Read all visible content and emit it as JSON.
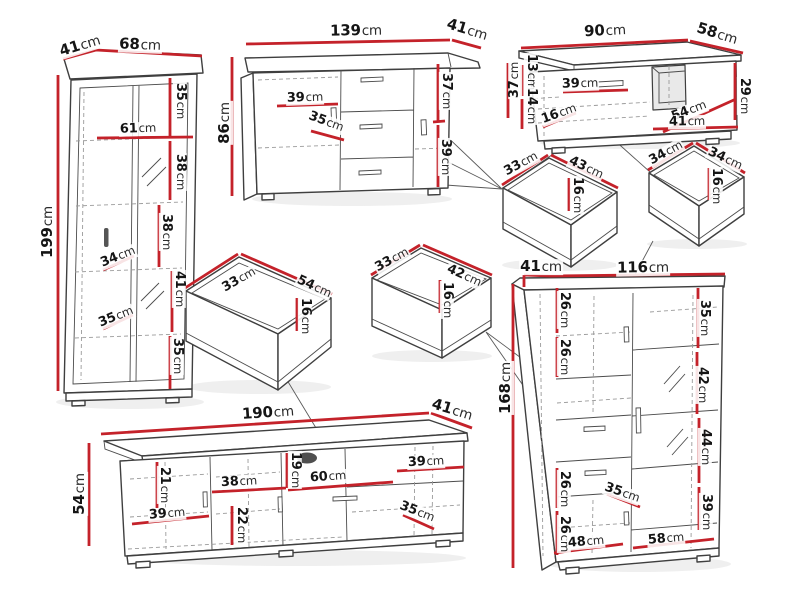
{
  "unit": "cm",
  "colors": {
    "dimension_line": "#c4222a",
    "outline": "#3f3f3f",
    "hidden_line": "#9a9a9a"
  },
  "pieces": [
    {
      "name": "tall-display-cabinet",
      "overall": {
        "width": "68",
        "depth": "41",
        "height": "199"
      },
      "labels": [
        {
          "v": "41",
          "x": 80,
          "y": 46,
          "r": -17,
          "s": 15
        },
        {
          "v": "68",
          "x": 140,
          "y": 45,
          "r": 2,
          "s": 15
        },
        {
          "v": "199",
          "x": 48,
          "y": 232,
          "r": -90,
          "s": 15
        },
        {
          "v": "35",
          "x": 180,
          "y": 101,
          "r": 90
        },
        {
          "v": "61",
          "x": 138,
          "y": 129,
          "r": -2
        },
        {
          "v": "38",
          "x": 180,
          "y": 172,
          "r": 90
        },
        {
          "v": "38",
          "x": 166,
          "y": 232,
          "r": 90
        },
        {
          "v": "34",
          "x": 118,
          "y": 257,
          "r": -22
        },
        {
          "v": "41",
          "x": 179,
          "y": 289,
          "r": 90
        },
        {
          "v": "35",
          "x": 116,
          "y": 317,
          "r": -22
        },
        {
          "v": "35",
          "x": 177,
          "y": 356,
          "r": 90
        }
      ]
    },
    {
      "name": "sideboard",
      "overall": {
        "width": "139",
        "depth": "41",
        "height": "86"
      },
      "labels": [
        {
          "v": "139",
          "x": 356,
          "y": 31,
          "r": -1,
          "s": 15
        },
        {
          "v": "41",
          "x": 467,
          "y": 30,
          "r": 17,
          "s": 15
        },
        {
          "v": "86",
          "x": 225,
          "y": 123,
          "r": -90,
          "s": 15
        },
        {
          "v": "39",
          "x": 305,
          "y": 98,
          "r": -2
        },
        {
          "v": "35",
          "x": 326,
          "y": 122,
          "r": 20
        },
        {
          "v": "37",
          "x": 446,
          "y": 91,
          "r": 90
        },
        {
          "v": "39",
          "x": 445,
          "y": 157,
          "r": 90
        }
      ]
    },
    {
      "name": "coffee-table",
      "overall": {
        "width": "90",
        "depth": "58",
        "height": "37"
      },
      "labels": [
        {
          "v": "90",
          "x": 605,
          "y": 31,
          "r": -3,
          "s": 15
        },
        {
          "v": "58",
          "x": 717,
          "y": 34,
          "r": 17,
          "s": 15
        },
        {
          "v": "37",
          "x": 515,
          "y": 80,
          "r": -90
        },
        {
          "v": "13",
          "x": 531,
          "y": 72,
          "r": 90
        },
        {
          "v": "14",
          "x": 531,
          "y": 106,
          "r": 90
        },
        {
          "v": "39",
          "x": 580,
          "y": 84,
          "r": -2
        },
        {
          "v": "16",
          "x": 559,
          "y": 114,
          "r": -20
        },
        {
          "v": "54",
          "x": 689,
          "y": 111,
          "r": -21
        },
        {
          "v": "41",
          "x": 687,
          "y": 122,
          "r": -1
        },
        {
          "v": "29",
          "x": 744,
          "y": 96,
          "r": 90
        }
      ]
    },
    {
      "name": "drawer-33x43",
      "overall": {
        "width": "43",
        "depth": "33",
        "height": "16"
      },
      "labels": [
        {
          "v": "33",
          "x": 521,
          "y": 164,
          "r": -29
        },
        {
          "v": "43",
          "x": 586,
          "y": 168,
          "r": 25
        },
        {
          "v": "16",
          "x": 577,
          "y": 195,
          "r": 90
        }
      ]
    },
    {
      "name": "drawer-34x34",
      "overall": {
        "width": "34",
        "depth": "34",
        "height": "16"
      },
      "labels": [
        {
          "v": "34",
          "x": 666,
          "y": 153,
          "r": -29
        },
        {
          "v": "34",
          "x": 725,
          "y": 159,
          "r": 25
        },
        {
          "v": "16",
          "x": 716,
          "y": 186,
          "r": 90
        }
      ]
    },
    {
      "name": "drawer-33x54",
      "overall": {
        "width": "54",
        "depth": "33",
        "height": "16"
      },
      "labels": [
        {
          "v": "33",
          "x": 239,
          "y": 280,
          "r": -30
        },
        {
          "v": "54",
          "x": 314,
          "y": 287,
          "r": 24
        },
        {
          "v": "16",
          "x": 305,
          "y": 316,
          "r": 90
        }
      ]
    },
    {
      "name": "drawer-33x42",
      "overall": {
        "width": "42",
        "depth": "33",
        "height": "16"
      },
      "labels": [
        {
          "v": "33",
          "x": 392,
          "y": 260,
          "r": -29
        },
        {
          "v": "42",
          "x": 464,
          "y": 276,
          "r": 24
        },
        {
          "v": "16",
          "x": 447,
          "y": 300,
          "r": 90
        }
      ]
    },
    {
      "name": "tv-stand",
      "overall": {
        "width": "190",
        "depth": "41",
        "height": "54"
      },
      "labels": [
        {
          "v": "190",
          "x": 268,
          "y": 413,
          "r": -4,
          "s": 15
        },
        {
          "v": "41",
          "x": 452,
          "y": 410,
          "r": 17,
          "s": 15
        },
        {
          "v": "54",
          "x": 80,
          "y": 494,
          "r": -90,
          "s": 15
        },
        {
          "v": "21",
          "x": 164,
          "y": 485,
          "r": 90
        },
        {
          "v": "38",
          "x": 239,
          "y": 482,
          "r": -3
        },
        {
          "v": "19",
          "x": 295,
          "y": 470,
          "r": 90
        },
        {
          "v": "60",
          "x": 328,
          "y": 477,
          "r": -4
        },
        {
          "v": "39",
          "x": 426,
          "y": 462,
          "r": -3
        },
        {
          "v": "39",
          "x": 167,
          "y": 514,
          "r": -5
        },
        {
          "v": "22",
          "x": 241,
          "y": 525,
          "r": 90
        },
        {
          "v": "35",
          "x": 417,
          "y": 512,
          "r": 21
        }
      ]
    },
    {
      "name": "highboard-cabinet",
      "overall": {
        "width": "116",
        "depth": "41",
        "height": "168"
      },
      "labels": [
        {
          "v": "41",
          "x": 541,
          "y": 267,
          "r": 0,
          "s": 15
        },
        {
          "v": "116",
          "x": 643,
          "y": 268,
          "r": -1,
          "s": 15
        },
        {
          "v": "168",
          "x": 506,
          "y": 388,
          "r": -90,
          "s": 15
        },
        {
          "v": "26",
          "x": 564,
          "y": 310,
          "r": 90
        },
        {
          "v": "26",
          "x": 564,
          "y": 357,
          "r": 90
        },
        {
          "v": "35",
          "x": 704,
          "y": 318,
          "r": 90
        },
        {
          "v": "42",
          "x": 702,
          "y": 385,
          "r": 90
        },
        {
          "v": "44",
          "x": 705,
          "y": 447,
          "r": 90
        },
        {
          "v": "26",
          "x": 564,
          "y": 489,
          "r": 90
        },
        {
          "v": "35",
          "x": 622,
          "y": 493,
          "r": 19
        },
        {
          "v": "26",
          "x": 564,
          "y": 534,
          "r": 90
        },
        {
          "v": "39",
          "x": 706,
          "y": 512,
          "r": 90
        },
        {
          "v": "48",
          "x": 586,
          "y": 542,
          "r": -5
        },
        {
          "v": "58",
          "x": 666,
          "y": 539,
          "r": -5
        }
      ]
    }
  ]
}
